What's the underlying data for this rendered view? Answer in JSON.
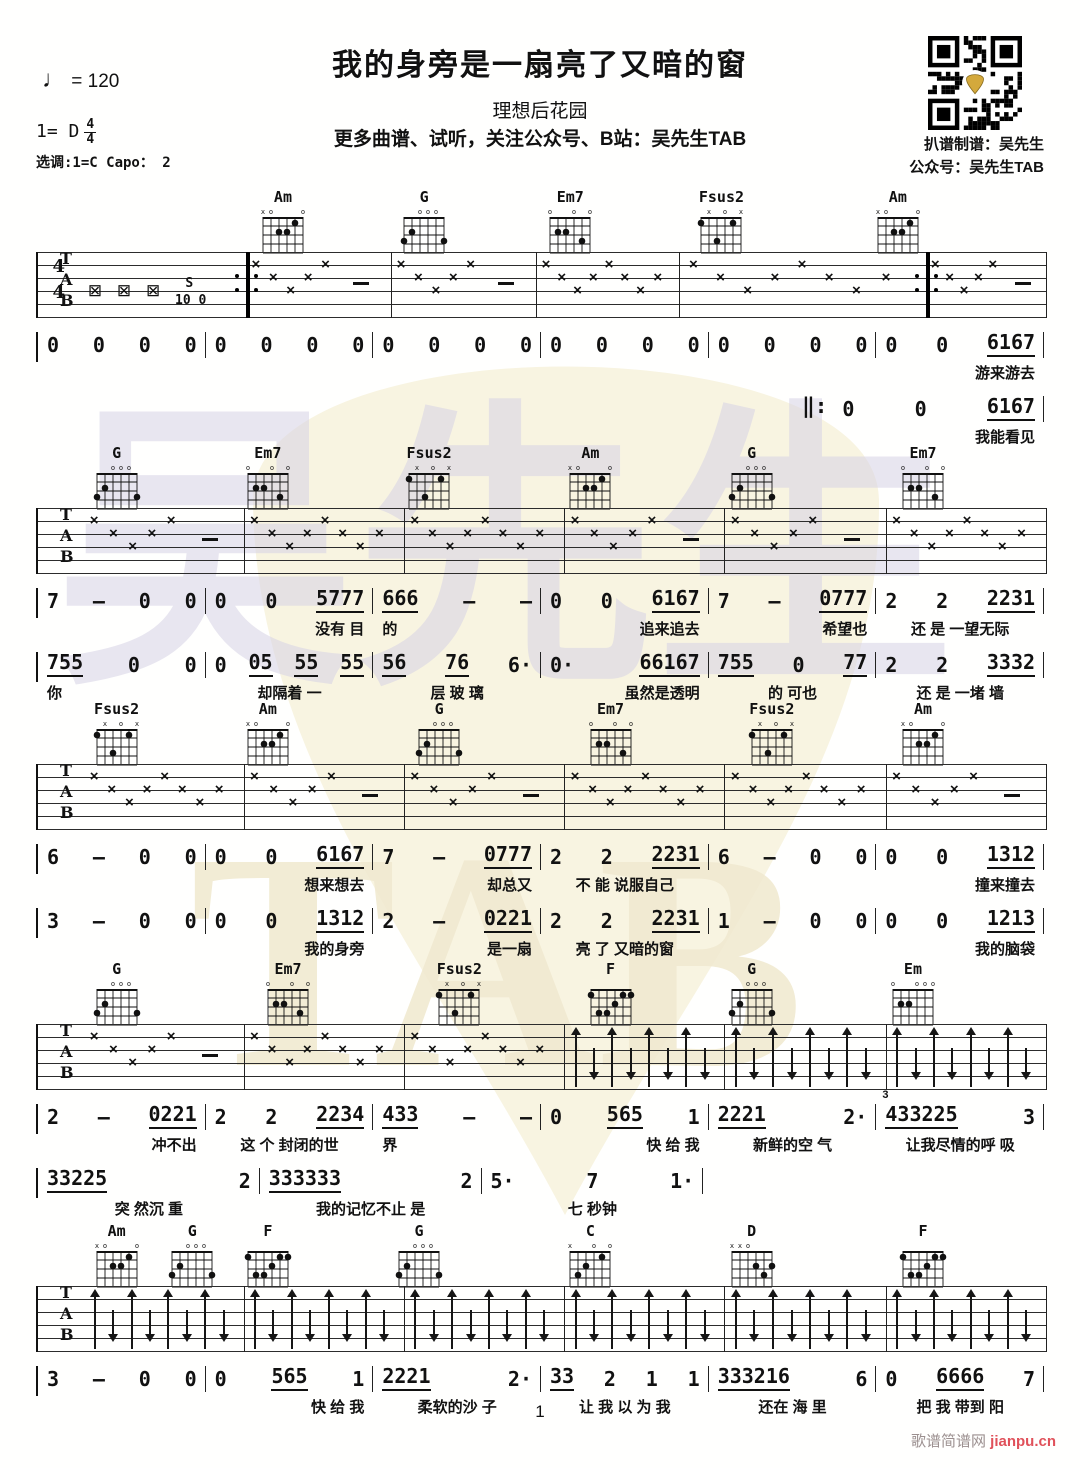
{
  "header": {
    "title": "我的身旁是一扇亮了又暗的窗",
    "artist": "理想后花园",
    "promo": "更多曲谱、试听，关注公众号、B站：吴先生TAB",
    "tempo_note": "♩",
    "tempo_value": "=  120",
    "key": "1= D",
    "time_numerator": "4",
    "time_denominator": "4",
    "transpose": "选调:1=C   Capo： 2",
    "credit1": "扒谱制谱：吴先生",
    "credit2": "公众号：吴先生TAB"
  },
  "watermark": {
    "text1": "吴先生",
    "text2": "TAB",
    "pick_color": "#f8f4e1",
    "text1_color": "#d7d3e5",
    "text2_color": "#f1ead1"
  },
  "footer": {
    "page": "1",
    "site": "歌谱简谱网",
    "site2": "jianpu.cn",
    "site2_color": "#e0515a"
  },
  "glyphs": {
    "mute": "×",
    "box": "⊠",
    "dash": "–",
    "repeat_pre": "‖:",
    "slide": "S",
    "slide_frets": "10 0"
  },
  "staff_labels": [
    "T",
    "A",
    "B"
  ],
  "chord_shapes": {
    "Am": {
      "markers": [
        "x",
        "o",
        "",
        "",
        "",
        "o"
      ],
      "dots": [
        [
          4,
          2
        ],
        [
          3,
          2
        ],
        [
          2,
          1
        ]
      ]
    },
    "G": {
      "markers": [
        "",
        "",
        "o",
        "o",
        "o",
        ""
      ],
      "dots": [
        [
          6,
          3
        ],
        [
          5,
          2
        ],
        [
          1,
          3
        ]
      ]
    },
    "Em7": {
      "markers": [
        "o",
        "",
        "",
        "o",
        "",
        "o"
      ],
      "dots": [
        [
          5,
          2
        ],
        [
          4,
          2
        ],
        [
          2,
          3
        ]
      ]
    },
    "Fsus2": {
      "markers": [
        "",
        "x",
        "",
        "o",
        "",
        "x"
      ],
      "dots": [
        [
          6,
          1
        ],
        [
          4,
          3
        ],
        [
          2,
          1
        ]
      ]
    },
    "F": {
      "markers": [
        "",
        "",
        "",
        "",
        "",
        ""
      ],
      "dots": [
        [
          6,
          1
        ],
        [
          5,
          3
        ],
        [
          4,
          3
        ],
        [
          3,
          2
        ],
        [
          2,
          1
        ],
        [
          1,
          1
        ]
      ]
    },
    "Em": {
      "markers": [
        "o",
        "",
        "",
        "o",
        "o",
        "o"
      ],
      "dots": [
        [
          5,
          2
        ],
        [
          4,
          2
        ]
      ]
    },
    "C": {
      "markers": [
        "x",
        "",
        "",
        "o",
        "",
        "o"
      ],
      "dots": [
        [
          5,
          3
        ],
        [
          4,
          2
        ],
        [
          2,
          1
        ]
      ]
    },
    "D": {
      "markers": [
        "x",
        "x",
        "o",
        "",
        "",
        ""
      ],
      "dots": [
        [
          3,
          2
        ],
        [
          2,
          3
        ],
        [
          1,
          2
        ]
      ]
    }
  },
  "systems": [
    {
      "chords": [
        {
          "n": "Am",
          "x": 24.5
        },
        {
          "n": "G",
          "x": 38.5
        },
        {
          "n": "Em7",
          "x": 53
        },
        {
          "n": "Fsus2",
          "x": 68
        },
        {
          "n": "Am",
          "x": 85.5
        }
      ],
      "staff": {
        "bounds": [
          0,
          20.6,
          35,
          49.4,
          63.6,
          88.1,
          100
        ],
        "patterns": [
          "intro",
          "xd",
          "xd",
          "x8",
          "x8",
          "xd"
        ],
        "time": [
          "4",
          "4"
        ],
        "repeats": [
          20.6,
          88.1
        ]
      },
      "lines": [
        {
          "tick": true,
          "measures": [
            {
              "n": "0 0 0 0"
            },
            {
              "n": "0 0 0 0"
            },
            {
              "n": "0 0 0 0"
            },
            {
              "n": "0 0 0 0"
            },
            {
              "n": "0 0 0 0"
            },
            {
              "n": "0 0 6167",
              "l": "游来游去",
              "la": "right"
            }
          ]
        },
        {
          "tick": false,
          "pre": "‖:",
          "spacer": 76,
          "measures": [
            {
              "n": "0 0 6167",
              "l": "我能看见",
              "la": "right"
            }
          ]
        }
      ]
    },
    {
      "chords": [
        {
          "n": "G",
          "x": 8
        },
        {
          "n": "Em7",
          "x": 23
        },
        {
          "n": "Fsus2",
          "x": 39
        },
        {
          "n": "Am",
          "x": 55
        },
        {
          "n": "G",
          "x": 71
        },
        {
          "n": "Em7",
          "x": 88
        }
      ],
      "staff": {
        "bounds": [
          4.5,
          20.4,
          36.3,
          52.2,
          68.1,
          84.1,
          100
        ],
        "patterns": [
          "xd",
          "x8",
          "x8",
          "xd",
          "xd",
          "x8"
        ]
      },
      "lines": [
        {
          "tick": true,
          "measures": [
            {
              "n": "7 - 0 0"
            },
            {
              "n": "0 0 5777",
              "l": "没有 目",
              "la": "right"
            },
            {
              "n": "666 - -",
              "l": "的",
              "la": "left"
            },
            {
              "n": "0 0 6167",
              "l": "追来追去",
              "la": "right"
            },
            {
              "n": "7 - 0777",
              "l": "希望也",
              "la": "right"
            },
            {
              "n": "2 2 2231",
              "l": "还 是 一望无际",
              "la": "center"
            }
          ]
        },
        {
          "tick": true,
          "measures": [
            {
              "n": "755 0 0",
              "l": "你",
              "la": "left"
            },
            {
              "n": "0 05 55 55",
              "l": "却隔着 一",
              "la": "center"
            },
            {
              "n": "56 76 6·",
              "l": "层 玻 璃",
              "la": "center"
            },
            {
              "n": "0· 66167",
              "l": "虽然是透明",
              "la": "right"
            },
            {
              "n": "755 0 77",
              "l": "的  可也",
              "la": "center"
            },
            {
              "n": "2 2 3332",
              "l": "还 是 一堵 墙",
              "la": "center"
            }
          ]
        }
      ]
    },
    {
      "chords": [
        {
          "n": "Fsus2",
          "x": 8
        },
        {
          "n": "Am",
          "x": 23
        },
        {
          "n": "G",
          "x": 40
        },
        {
          "n": "Em7",
          "x": 57
        },
        {
          "n": "Fsus2",
          "x": 73
        },
        {
          "n": "Am",
          "x": 88
        }
      ],
      "staff": {
        "bounds": [
          4.5,
          20.4,
          36.3,
          52.2,
          68.1,
          84.1,
          100
        ],
        "patterns": [
          "x8",
          "xd",
          "xd",
          "x8",
          "x8",
          "xd"
        ]
      },
      "lines": [
        {
          "tick": true,
          "measures": [
            {
              "n": "6 - 0 0"
            },
            {
              "n": "0 0 6167",
              "l": "想来想去",
              "la": "right"
            },
            {
              "n": "7 - 0777",
              "l": "却总又",
              "la": "right"
            },
            {
              "n": "2 2 2231",
              "l": "不 能 说服自己",
              "la": "center"
            },
            {
              "n": "6 - 0 0"
            },
            {
              "n": "0 0 1312",
              "l": "撞来撞去",
              "la": "right"
            }
          ]
        },
        {
          "tick": true,
          "measures": [
            {
              "n": "3 - 0 0"
            },
            {
              "n": "0 0 1312",
              "l": "我的身旁",
              "la": "right"
            },
            {
              "n": "2 - 0221",
              "l": "是一扇",
              "la": "right"
            },
            {
              "n": "2 2 2231",
              "l": "亮 了 又暗的窗",
              "la": "center"
            },
            {
              "n": "1 - 0 0"
            },
            {
              "n": "0 0 1213",
              "l": "我的脑袋",
              "la": "right"
            }
          ]
        }
      ]
    },
    {
      "chords": [
        {
          "n": "G",
          "x": 8
        },
        {
          "n": "Em7",
          "x": 25
        },
        {
          "n": "Fsus2",
          "x": 42
        },
        {
          "n": "F",
          "x": 57
        },
        {
          "n": "G",
          "x": 71
        },
        {
          "n": "Em",
          "x": 87
        }
      ],
      "staff": {
        "bounds": [
          4.5,
          20.4,
          36.3,
          52.2,
          68.1,
          84.1,
          100
        ],
        "patterns": [
          "xd",
          "x8",
          "x8",
          "ar",
          "ar",
          "ar"
        ]
      },
      "lines": [
        {
          "tick": true,
          "measures": [
            {
              "n": "2 - 0221",
              "l": "冲不出",
              "la": "right"
            },
            {
              "n": "2 2 2234",
              "l": "这 个 封闭的世",
              "la": "center"
            },
            {
              "n": "433 - -",
              "l": "界",
              "la": "left"
            },
            {
              "n": "0 565 1",
              "l": "快 给 我",
              "la": "right"
            },
            {
              "n": "2221 2·",
              "l": "新鲜的空 气",
              "la": "center"
            },
            {
              "n": "433225 3",
              "l": "让我尽情的呼 吸",
              "la": "center",
              "tri": "3"
            }
          ]
        },
        {
          "tick": true,
          "partial": 22,
          "trailer": 34,
          "measures": [
            {
              "n": "33225 2",
              "l": "突 然沉 重",
              "la": "center"
            },
            {
              "n": "333333 2",
              "l": "我的记忆不止 是",
              "la": "center"
            },
            {
              "n": "5· 7 1·",
              "l": "七 秒钟",
              "la": "center"
            }
          ]
        }
      ]
    },
    {
      "chords": [
        {
          "n": "Am",
          "x": 8
        },
        {
          "n": "G",
          "x": 15.5
        },
        {
          "n": "F",
          "x": 23
        },
        {
          "n": "G",
          "x": 38
        },
        {
          "n": "C",
          "x": 55
        },
        {
          "n": "D",
          "x": 71
        },
        {
          "n": "F",
          "x": 88
        }
      ],
      "staff": {
        "bounds": [
          4.5,
          20.4,
          36.3,
          52.2,
          68.1,
          84.1,
          100
        ],
        "patterns": [
          "ar",
          "ar",
          "ar",
          "ar",
          "ar",
          "ar"
        ]
      },
      "lines": [
        {
          "tick": true,
          "measures": [
            {
              "n": "3 - 0 0"
            },
            {
              "n": "0 565 1",
              "l": "快 给 我",
              "la": "right"
            },
            {
              "n": "2221 2·",
              "l": "柔软的沙 子",
              "la": "center"
            },
            {
              "n": "33 2 1 1",
              "l": "让 我 以 为 我",
              "la": "center"
            },
            {
              "n": "333216 6",
              "l": "还在 海  里",
              "la": "center"
            },
            {
              "n": "0 6666 7",
              "l": "把 我 带到 阳",
              "la": "center"
            }
          ]
        }
      ]
    }
  ]
}
